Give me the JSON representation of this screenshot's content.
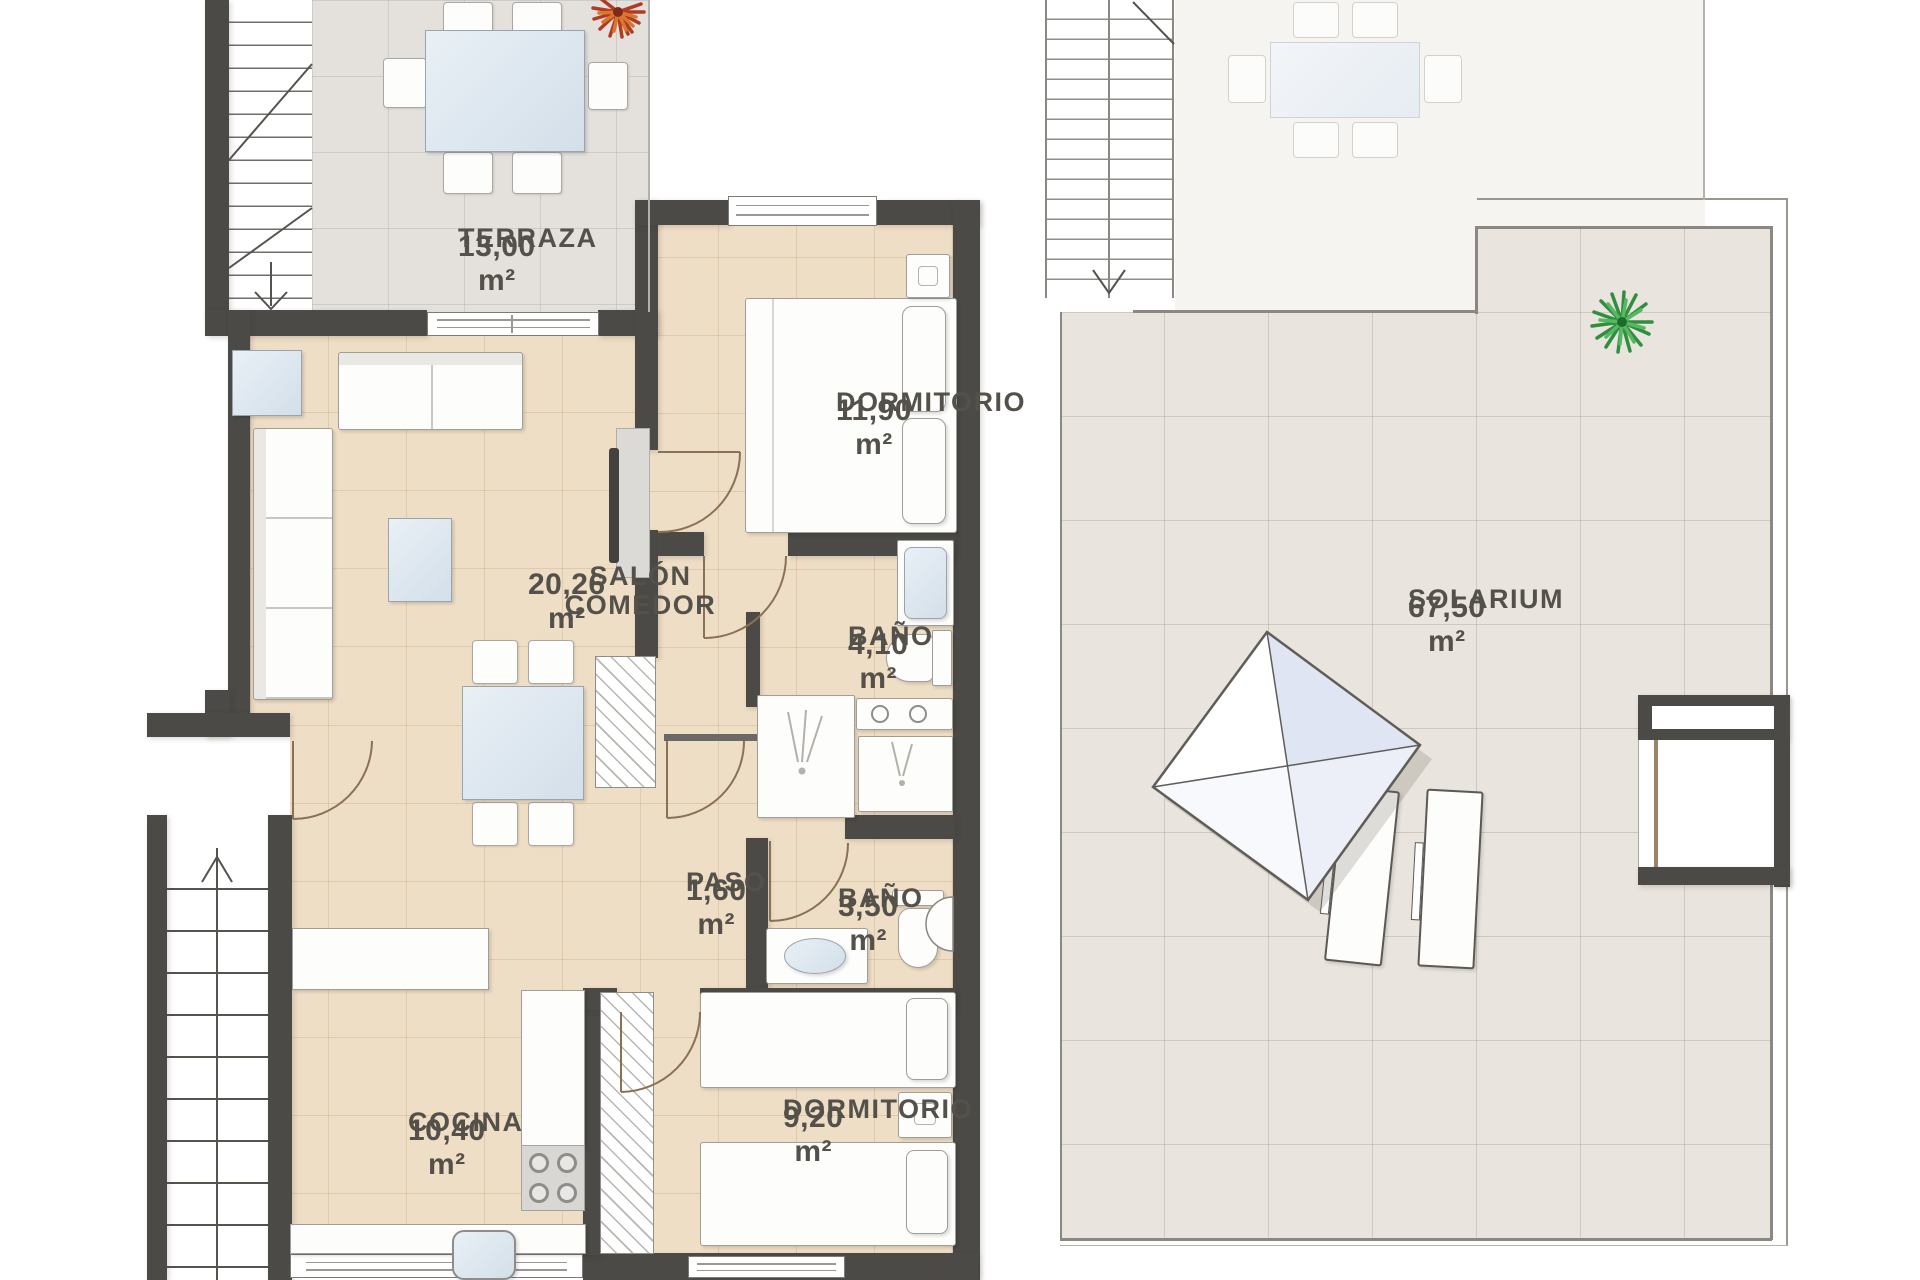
{
  "plan": {
    "type": "apartment-floor-plan",
    "levels": [
      "main-floor",
      "roof-solarium"
    ]
  },
  "rooms": {
    "terraza": {
      "name": "TERRAZA",
      "area": "13,00 m²"
    },
    "salon": {
      "name": "SALÓN COMEDOR",
      "area": "20,26 m²"
    },
    "dormitorio1": {
      "name": "DORMITORIO",
      "area": "11,90 m²"
    },
    "bano1": {
      "name": "BAÑO",
      "area": "4,10 m²"
    },
    "paso": {
      "name": "PASO",
      "area": "1,60 m²"
    },
    "bano2": {
      "name": "BAÑO",
      "area": "3,50 m²"
    },
    "cocina": {
      "name": "COCINA",
      "area": "10,40 m²"
    },
    "dormitorio2": {
      "name": "DORMITORIO",
      "area": "9,20 m²"
    },
    "solarium": {
      "name": "SOLARIUM",
      "area": "67,50 m²"
    }
  },
  "colors": {
    "wall": "#4b4a46",
    "floor_interior": "#efdec6",
    "floor_terrace": "#e4e1dd",
    "floor_solarium": "#e9e4dd",
    "glass": "#d3dfe9",
    "label_text": "#54504a",
    "plant_green": "#2f8f3e",
    "plant_red": "#b03a22"
  }
}
